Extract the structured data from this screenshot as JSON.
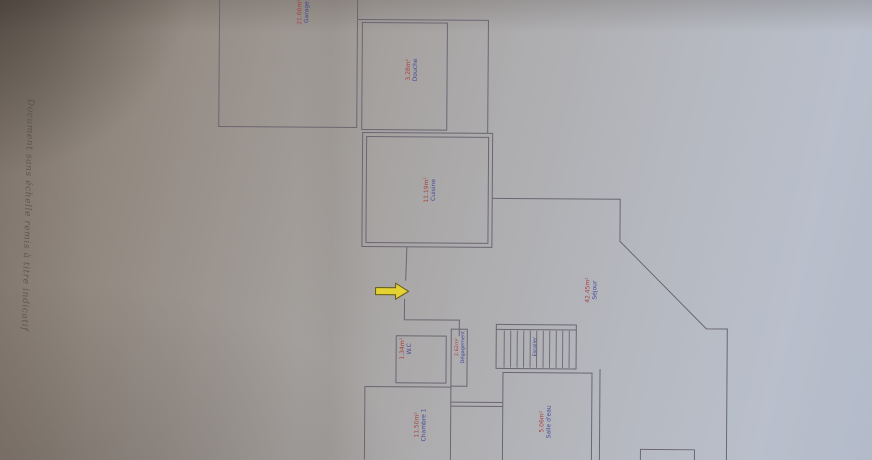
{
  "photo": {
    "disclaimer": "Document sans échelle remis à titre indicatif"
  },
  "colors": {
    "room_name_text": "#3c4095",
    "room_area_text": "#a93a3a",
    "wall_line": "#6b6672",
    "arrow_fill": "#e4d132",
    "arrow_outline": "#615a12",
    "paper_dark": "#84796f",
    "paper_light": "#b9bfcb"
  },
  "rooms": [
    {
      "id": "garage",
      "name": "Garage",
      "area": "21.60m²"
    },
    {
      "id": "douche",
      "name": "Douche",
      "area": "3.28m²"
    },
    {
      "id": "cuisine",
      "name": "Cuisine",
      "area": "11.19m²"
    },
    {
      "id": "sejour",
      "name": "Séjour",
      "area": "42.45m²"
    },
    {
      "id": "wc",
      "name": "W.C",
      "area": "1.34m²"
    },
    {
      "id": "degagement",
      "name": "Dégagement",
      "area": "2.62m²"
    },
    {
      "id": "escalier",
      "name": "Escalier",
      "area": ""
    },
    {
      "id": "salle-eau",
      "name": "Salle d'eau",
      "area": "5.06m²"
    },
    {
      "id": "chambre-1",
      "name": "Chambre 1",
      "area": "11.50m²"
    }
  ],
  "icons": {
    "entrance_arrow": "entrance direction arrow (points right)"
  }
}
